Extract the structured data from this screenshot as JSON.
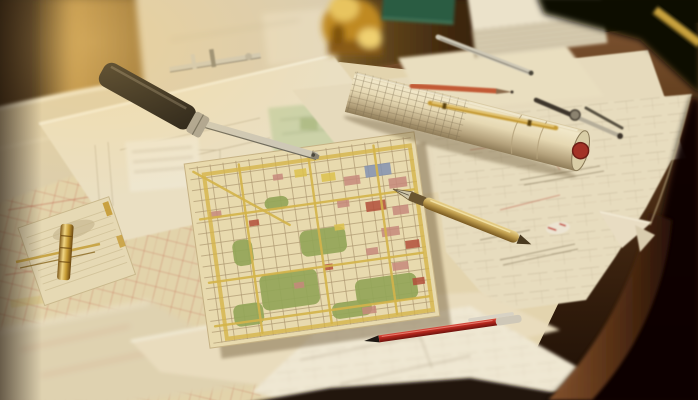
{
  "scene": {
    "alt": "Warmly lit wooden drafting desk covered with overlapping city street maps and technical drawings; a rolled plan tube with a red core, a black-handled map ruler, a metal caliper, a brass divider resting on a notepad, drafting compasses, a gold fountain pen, a red ballpoint pen, pencils, a thick book, a green notebook and a blurred brass instrument."
  },
  "objects": [
    "wooden-desk",
    "city-street-map",
    "map-sheets",
    "technical-drawing-sheet",
    "curled-sheet",
    "rolled-plan-tube",
    "black-handle-ruler",
    "metal-caliper",
    "notepad",
    "brass-divider",
    "drafting-compass",
    "silver-pencil",
    "red-pencil",
    "brass-pen",
    "gold-fountain-pen",
    "red-ballpoint-pen",
    "yellow-pencil",
    "book",
    "green-notebook",
    "brass-instrument",
    "eraser"
  ],
  "colors": {
    "bg-dark": "#150d05",
    "wall-dark-left": "#2e1c08",
    "glow": "#bb8f44",
    "paper": "#eadfc2",
    "paper-warm": "#e3d4ae",
    "paper-bright": "#f2ebd6",
    "map-base": "#e8daae",
    "map-line": "#a8916a",
    "map-road": "#d4b44a",
    "park": "#92a558",
    "block-pink": "#c6887b",
    "block-red": "#b14f3b",
    "block-blue": "#8292b2",
    "block-yellow": "#dcc14d",
    "red-street": "#c05c48",
    "sketch-ink": "#8d7b5c",
    "tool-black": "#17130e",
    "metal": "#cec8b6",
    "metal-dark": "#8b8472",
    "brass": "#c59a33",
    "brass-hi": "#f0d584",
    "brass-dark": "#7c5617",
    "tube-end": "#d9cda6",
    "tube-red": "#a33226",
    "pencil-red": "#c25a36",
    "pencil-yellow": "#c9a23c",
    "book-page": "#d9ceb2",
    "book-top": "#ebe2ca",
    "notebook-green": "#2c5c42",
    "eraser-white": "#ece4d2"
  },
  "map": {
    "parks": [
      {
        "x": -58,
        "y": 28,
        "w": 58,
        "h": 36
      },
      {
        "x": -12,
        "y": -10,
        "w": 46,
        "h": 26
      },
      {
        "x": 36,
        "y": 46,
        "w": 62,
        "h": 26
      },
      {
        "x": -88,
        "y": 54,
        "w": 30,
        "h": 22
      },
      {
        "x": 10,
        "y": 66,
        "w": 40,
        "h": 16
      },
      {
        "x": -42,
        "y": -48,
        "w": 24,
        "h": 13
      },
      {
        "x": -80,
        "y": -10,
        "w": 20,
        "h": 26
      }
    ],
    "blocks": [
      {
        "x": 62,
        "y": -66,
        "w": 26,
        "h": 12,
        "c": "block-blue"
      },
      {
        "x": 84,
        "y": -50,
        "w": 18,
        "h": 10,
        "c": "block-pink"
      },
      {
        "x": 40,
        "y": -58,
        "w": 16,
        "h": 9,
        "c": "block-pink"
      },
      {
        "x": 18,
        "y": -64,
        "w": 14,
        "h": 8,
        "c": "block-yellow"
      },
      {
        "x": -8,
        "y": -72,
        "w": 12,
        "h": 8,
        "c": "block-yellow"
      },
      {
        "x": 58,
        "y": -30,
        "w": 20,
        "h": 10,
        "c": "block-red"
      },
      {
        "x": 84,
        "y": -22,
        "w": 16,
        "h": 9,
        "c": "block-pink"
      },
      {
        "x": 30,
        "y": -36,
        "w": 12,
        "h": 8,
        "c": "block-pink"
      },
      {
        "x": 70,
        "y": -2,
        "w": 18,
        "h": 9,
        "c": "block-pink"
      },
      {
        "x": 92,
        "y": 14,
        "w": 14,
        "h": 8,
        "c": "block-red"
      },
      {
        "x": 52,
        "y": 16,
        "w": 12,
        "h": 7,
        "c": "block-pink"
      },
      {
        "x": 76,
        "y": 34,
        "w": 16,
        "h": 8,
        "c": "block-pink"
      },
      {
        "x": 94,
        "y": 52,
        "w": 12,
        "h": 7,
        "c": "block-red"
      },
      {
        "x": -30,
        "y": -70,
        "w": 10,
        "h": 6,
        "c": "block-pink"
      },
      {
        "x": -98,
        "y": -42,
        "w": 12,
        "h": 7,
        "c": "block-pink"
      },
      {
        "x": -60,
        "y": -28,
        "w": 10,
        "h": 6,
        "c": "block-red"
      },
      {
        "x": 24,
        "y": -12,
        "w": 10,
        "h": 6,
        "c": "block-yellow"
      },
      {
        "x": -24,
        "y": 40,
        "w": 10,
        "h": 6,
        "c": "block-pink"
      },
      {
        "x": 8,
        "y": 26,
        "w": 9,
        "h": 6,
        "c": "block-red"
      },
      {
        "x": 40,
        "y": 74,
        "w": 14,
        "h": 7,
        "c": "block-pink"
      }
    ],
    "roads_v": [
      -62,
      8,
      74
    ],
    "roads_h": [
      -36,
      28,
      72
    ],
    "diagonal": {
      "x1": -108,
      "y1": -84,
      "x2": -20,
      "y2": -18
    }
  },
  "book": {
    "page_line_fracs": [
      0.16,
      0.33,
      0.5,
      0.67,
      0.84
    ]
  },
  "notepad": {
    "line_count": 9
  }
}
